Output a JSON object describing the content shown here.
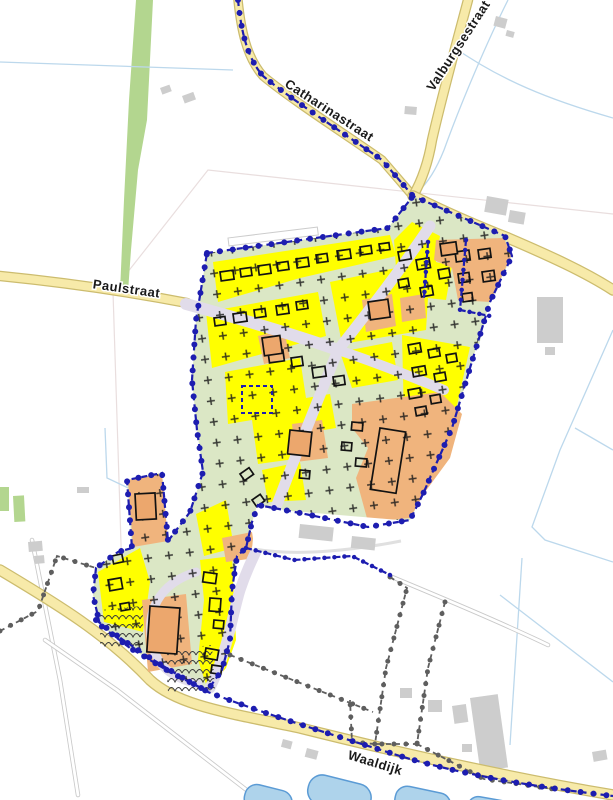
{
  "map": {
    "type": "zoning-plan-map",
    "road_labels": [
      {
        "id": "catharinastraat",
        "text": "Catharinastraat"
      },
      {
        "id": "valburgsestraat",
        "text": "Valburgsestraat"
      },
      {
        "id": "paulstraat",
        "text": "Paulstraat"
      },
      {
        "id": "waaldijk",
        "text": "Waaldijk"
      }
    ],
    "colors": {
      "background": "#ffffff",
      "road_fill": "#f7eaa9",
      "road_casing": "#ccbc6e",
      "plan_boundary": "#1d1db0",
      "adjacent_boundary": "#5e5e5e",
      "agri_green": "#dbe7c5",
      "res_yellow": "#ffff00",
      "orange_zone": "#f0b47d",
      "lavender_road": "#e1dcea",
      "building_gray": "#cdcdcd",
      "footprint_black": "#121212",
      "water_fill": "#aed3eb",
      "water_stroke": "#5b9bd5",
      "ditch_blue": "#bcd8ec",
      "green_strip": "#b3d68f",
      "label_black": "#1a1a1a"
    }
  }
}
